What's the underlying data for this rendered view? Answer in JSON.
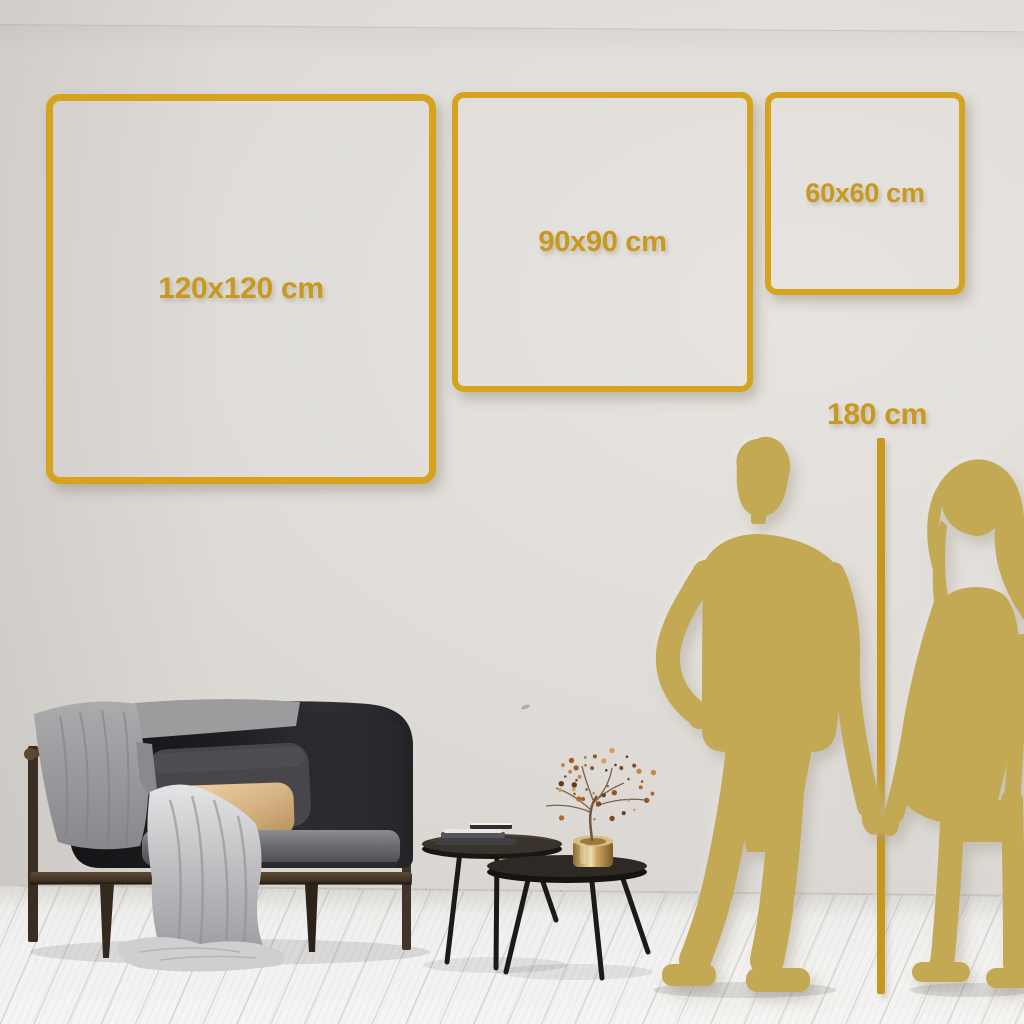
{
  "size_guide": {
    "title_hint": "wall-art size comparison",
    "frames": [
      {
        "id": "120",
        "label": "120x120 cm",
        "width_cm": 120,
        "height_cm": 120
      },
      {
        "id": "90",
        "label": "90x90 cm",
        "width_cm": 90,
        "height_cm": 90
      },
      {
        "id": "60",
        "label": "60x60 cm",
        "width_cm": 60,
        "height_cm": 60
      }
    ],
    "height_reference": {
      "label": "180 cm",
      "value_cm": 180
    }
  },
  "scene": {
    "illustrations": [
      "sofa-illustration",
      "blanket-illustration",
      "pillow-illustrations",
      "coffee-tables-illustration",
      "books-illustration",
      "brass-vase-illustration",
      "berry-plant-illustration",
      "man-silhouette",
      "woman-silhouette"
    ]
  },
  "colors": {
    "frame_gold": "#D5A31D",
    "label_gold": "#C8991E",
    "measure_line_gold": "#C8981E",
    "silhouette_gold": "#C3A953",
    "wall_light": "#E7E4E0",
    "wall_shade": "#D2CFCB",
    "floor_white": "#F3F2F0"
  }
}
